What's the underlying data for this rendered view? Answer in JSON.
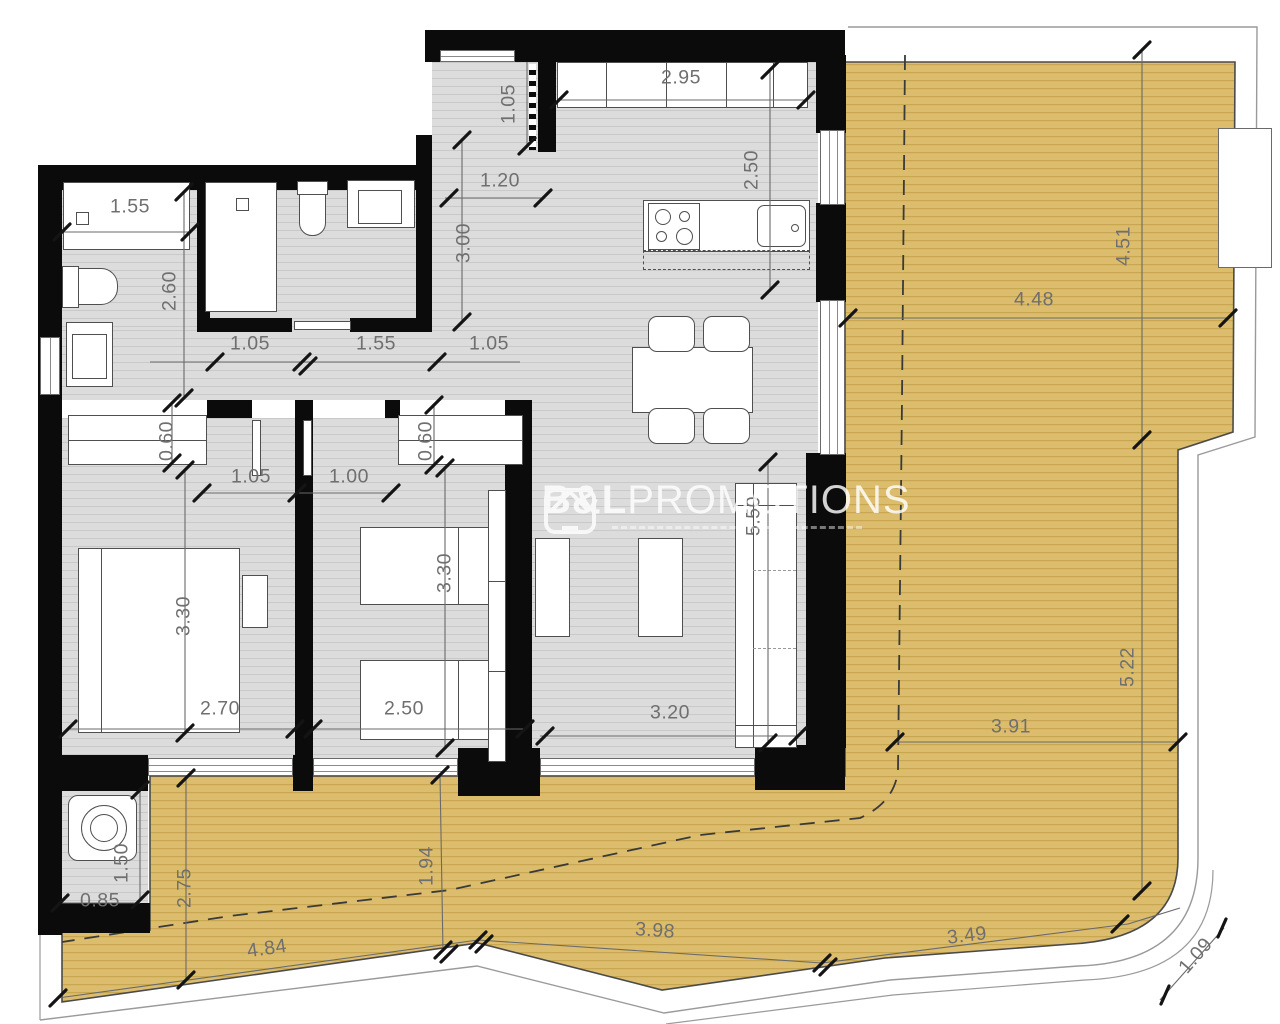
{
  "watermark": {
    "brand_bold": "B&L",
    "brand_rest": "PROMOTIONS"
  },
  "colors": {
    "wall": "#0b0b0b",
    "interior_floor": "#dcdcdc",
    "terrace": "#dcbd6e",
    "terrace_line": "#c2a045",
    "dimension_text": "#6f6f6f",
    "watermark": "#ffffff"
  },
  "dimensions": [
    {
      "value": "1.55",
      "x": 130,
      "y": 207,
      "rot": 0
    },
    {
      "value": "2.60",
      "x": 170,
      "y": 291,
      "rot": -90
    },
    {
      "value": "1.05",
      "x": 250,
      "y": 344,
      "rot": 0
    },
    {
      "value": "1.55",
      "x": 376,
      "y": 344,
      "rot": 0
    },
    {
      "value": "1.05",
      "x": 489,
      "y": 344,
      "rot": 0
    },
    {
      "value": "1.20",
      "x": 500,
      "y": 181,
      "rot": 0
    },
    {
      "value": "1.05",
      "x": 509,
      "y": 104,
      "rot": -90
    },
    {
      "value": "2.95",
      "x": 681,
      "y": 78,
      "rot": 0
    },
    {
      "value": "2.50",
      "x": 752,
      "y": 170,
      "rot": -90
    },
    {
      "value": "3.00",
      "x": 464,
      "y": 243,
      "rot": -90
    },
    {
      "value": "4.48",
      "x": 1034,
      "y": 300,
      "rot": 0
    },
    {
      "value": "4.51",
      "x": 1124,
      "y": 246,
      "rot": -90
    },
    {
      "value": "0.60",
      "x": 167,
      "y": 441,
      "rot": -90
    },
    {
      "value": "0.60",
      "x": 426,
      "y": 441,
      "rot": -90
    },
    {
      "value": "1.05",
      "x": 251,
      "y": 477,
      "rot": 0
    },
    {
      "value": "1.00",
      "x": 349,
      "y": 477,
      "rot": 0
    },
    {
      "value": "3.30",
      "x": 184,
      "y": 616,
      "rot": -90
    },
    {
      "value": "3.30",
      "x": 445,
      "y": 573,
      "rot": -90
    },
    {
      "value": "5.50",
      "x": 754,
      "y": 516,
      "rot": -90
    },
    {
      "value": "2.70",
      "x": 220,
      "y": 709,
      "rot": 0
    },
    {
      "value": "2.50",
      "x": 404,
      "y": 709,
      "rot": 0
    },
    {
      "value": "3.20",
      "x": 670,
      "y": 713,
      "rot": 0
    },
    {
      "value": "3.91",
      "x": 1011,
      "y": 727,
      "rot": 0
    },
    {
      "value": "5.22",
      "x": 1128,
      "y": 667,
      "rot": -90
    },
    {
      "value": "1.50",
      "x": 122,
      "y": 863,
      "rot": -90
    },
    {
      "value": "0.85",
      "x": 100,
      "y": 901,
      "rot": 0
    },
    {
      "value": "2.75",
      "x": 185,
      "y": 888,
      "rot": -90
    },
    {
      "value": "1.94",
      "x": 427,
      "y": 866,
      "rot": -90
    },
    {
      "value": "4.84",
      "x": 267,
      "y": 949,
      "rot": -8
    },
    {
      "value": "3.98",
      "x": 655,
      "y": 931,
      "rot": 4
    },
    {
      "value": "3.49",
      "x": 967,
      "y": 936,
      "rot": -7
    },
    {
      "value": "1.09",
      "x": 1196,
      "y": 956,
      "rot": -49
    }
  ]
}
